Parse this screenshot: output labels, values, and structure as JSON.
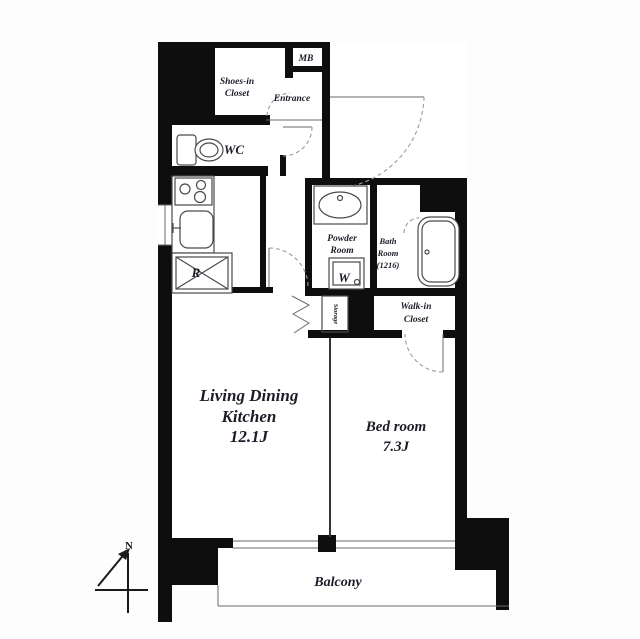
{
  "colors": {
    "wall": "#0e0e0e",
    "thin_line": "#4a4a4a",
    "door_arc": "#9a9a9a",
    "text": "#1c1c28",
    "background": "#fdfdfd"
  },
  "labels": {
    "shoes_closet_1": "Shoes-in",
    "shoes_closet_2": "Closet",
    "mb": "MB",
    "entrance": "Entrance",
    "wc": "WC",
    "powder_1": "Powder",
    "powder_2": "Room",
    "bath_1": "Bath",
    "bath_2": "Room",
    "bath_3": "(1216)",
    "washer": "W",
    "fridge": "R",
    "storage": "Storage",
    "walkin_1": "Walk-in",
    "walkin_2": "Closet",
    "ldk_1": "Living Dining",
    "ldk_2": "Kitchen",
    "ldk_3": "12.1J",
    "bedroom_1": "Bed room",
    "bedroom_2": "7.3J",
    "balcony": "Balcony",
    "compass_north": "N"
  }
}
